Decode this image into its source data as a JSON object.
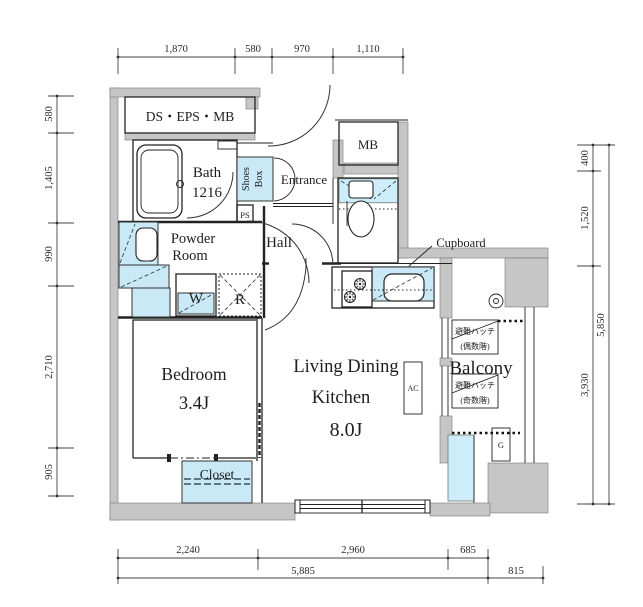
{
  "title": "apartment-floor-plan",
  "colors": {
    "wall_gray": "#c6c6c6",
    "fixture_blue": "#c9e9f6",
    "line": "#222222"
  },
  "rooms": {
    "ds_eps_mb": "DS・EPS・MB",
    "bath": [
      "Bath",
      "1216"
    ],
    "shoes_box": [
      "Shoes",
      "Box"
    ],
    "entrance": "Entrance",
    "meter_box": "MB",
    "pipe_space": "PS",
    "powder_room": [
      "Powder",
      "Room"
    ],
    "hall": "Hall",
    "washing_machine": "W",
    "refrigerator": "R",
    "bedroom": [
      "Bedroom",
      "3.4J"
    ],
    "ldk": [
      "Living Dining",
      "Kitchen",
      "8.0J"
    ],
    "closet": "Closet",
    "cupboard": "Cupboard",
    "balcony": "Balcony",
    "air_conditioner": "AC",
    "gas_meter": "G",
    "hatch_even": [
      "避難ハッチ",
      "(偶数階)"
    ],
    "hatch_odd": [
      "避難ハッチ",
      "(奇数階)"
    ]
  },
  "dimensions": {
    "top": [
      "1,870",
      "580",
      "970",
      "1,110"
    ],
    "left": [
      "580",
      "1,405",
      "990",
      "2,710",
      "905"
    ],
    "right": [
      "400",
      "1,520",
      "3,930",
      "5,850"
    ],
    "bottom": [
      "2,240",
      "2,960",
      "685",
      "5,885",
      "815"
    ]
  }
}
